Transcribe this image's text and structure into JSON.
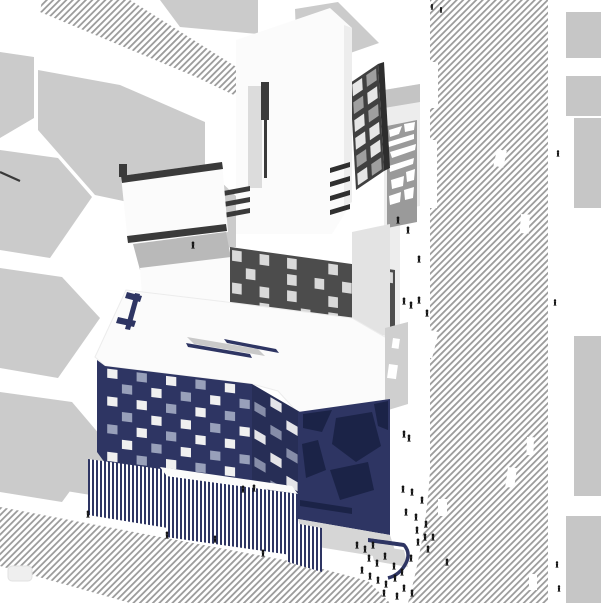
{
  "scene": {
    "label": "Architectural axonometric site rendering: navy checkered building with striped base, white tower, dark towers, hatched streets and pedestrians"
  },
  "palette": {
    "paper": "#ffffff",
    "hatch": "#9c9c9c",
    "block": "#cbcbcb",
    "block2": "#c6c6c6",
    "navy": "#2e3563",
    "navy_dark": "#1b2347",
    "se_navy": "#272e56",
    "white_bld": "#fbfbfb",
    "shade": "#ededed",
    "shade2": "#dcdcdc",
    "lightgray": "#e3e3e3",
    "terrace": "#b9b9b9",
    "dark": "#3a3a3a",
    "dark2": "#2f2f2f",
    "dark_tower": "#404040",
    "dark_tower_side": "#2e2e2e",
    "band_dark": "#4c4c4c",
    "collage": "#9a9a9a",
    "floor": "#d6d6d6",
    "cap": "#c4c4c4",
    "bridging": "#cfcfcf",
    "skylight": "#c9c9c9",
    "car": "#efefef",
    "people": "#141414"
  },
  "facades": {
    "front_sw": {
      "cols": 10,
      "rows": 7,
      "pattern": [
        "WnBnWnBnWn",
        "nBnWnBnWnB",
        "WnWnBnWnBn",
        "nBnWnWnBnW",
        "BnWnBnWnWn",
        "nWnBnWnBnB",
        "WnBnWnBnWn"
      ],
      "colors": {
        "W": "#f0f0f0",
        "B": "#98a0ba"
      }
    },
    "front_se": {
      "cols": 3,
      "rows": 7,
      "pattern": [
        "nWn",
        "BnW",
        "nBn",
        "WnB",
        "nWn",
        "BnW",
        "nBn"
      ],
      "colors": {
        "W": "#e4e4e8",
        "B": "#868da8"
      }
    },
    "back_band": {
      "cols": 12,
      "rows": 4,
      "pattern": [
        "LnLnLnnLnLnL",
        "nLnnLnLnLnLn",
        "LnLnLnnLnLnn",
        "nnLnnLnLnnLn"
      ],
      "colors": {
        "L": "#d9d9d9"
      }
    },
    "dark_tower": {
      "cols": 2,
      "rows": 6,
      "pattern": [
        "WG",
        "GW",
        "WG",
        "WW",
        "GW",
        "WG"
      ],
      "colors": {
        "W": "#e6e6e6",
        "G": "#9f9f9f"
      }
    }
  },
  "people": {
    "color": "#141414",
    "positions": [
      [
        193,
        249
      ],
      [
        398,
        224
      ],
      [
        408,
        234
      ],
      [
        419,
        263
      ],
      [
        432,
        10,
        0.8
      ],
      [
        441,
        13,
        0.8
      ],
      [
        558,
        157,
        0.9
      ],
      [
        404,
        305
      ],
      [
        411,
        309
      ],
      [
        419,
        304
      ],
      [
        427,
        317
      ],
      [
        555,
        306,
        0.9
      ],
      [
        404,
        438
      ],
      [
        409,
        442
      ],
      [
        403,
        493
      ],
      [
        412,
        496
      ],
      [
        422,
        504
      ],
      [
        406,
        516
      ],
      [
        416,
        521
      ],
      [
        426,
        528
      ],
      [
        433,
        541
      ],
      [
        418,
        546
      ],
      [
        428,
        553
      ],
      [
        447,
        566
      ],
      [
        557,
        568,
        0.9
      ],
      [
        559,
        592,
        0.9
      ],
      [
        357,
        549
      ],
      [
        365,
        553
      ],
      [
        373,
        549
      ],
      [
        369,
        562
      ],
      [
        377,
        567
      ],
      [
        385,
        560
      ],
      [
        362,
        574
      ],
      [
        370,
        580
      ],
      [
        378,
        584
      ],
      [
        386,
        588
      ],
      [
        395,
        582
      ],
      [
        402,
        576
      ],
      [
        394,
        570
      ],
      [
        404,
        592
      ],
      [
        412,
        597
      ],
      [
        397,
        600
      ],
      [
        384,
        597
      ],
      [
        411,
        562
      ],
      [
        417,
        534
      ],
      [
        425,
        541
      ],
      [
        88,
        518
      ],
      [
        167,
        539
      ],
      [
        215,
        543
      ],
      [
        243,
        493
      ],
      [
        254,
        492
      ],
      [
        263,
        557
      ]
    ]
  },
  "road_markings": [
    [
      497,
      149,
      10,
      17,
      12
    ],
    [
      521,
      214,
      9,
      19,
      4
    ],
    [
      426,
      329,
      13,
      27,
      14
    ],
    [
      527,
      437,
      7,
      18,
      2
    ],
    [
      508,
      467,
      9,
      20,
      8
    ],
    [
      438,
      499,
      9,
      17,
      0
    ],
    [
      529,
      574,
      8,
      16,
      0
    ]
  ]
}
